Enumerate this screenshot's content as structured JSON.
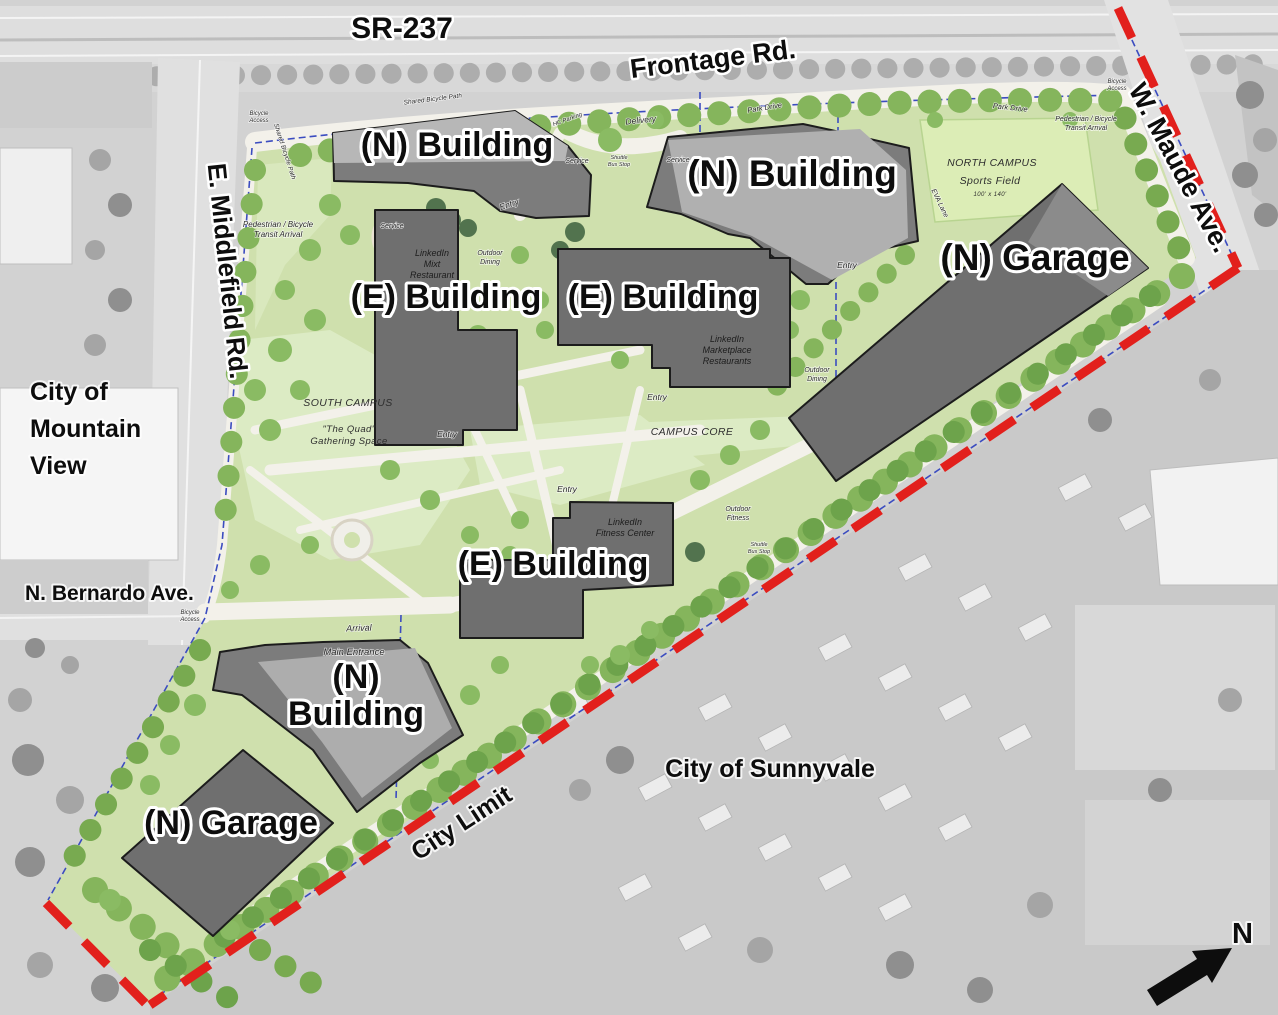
{
  "map_title": "LinkedIn campus site plan",
  "roads": {
    "sr237": "SR-237",
    "frontage": "Frontage Rd.",
    "maude": "W. Maude Ave.",
    "middlefield": "E. Middlefield Rd.",
    "bernardo": "N. Bernardo Ave.",
    "park_drive": "Park Drive",
    "eva_lane": "EVA Lane",
    "shared_path": "Shared Bicycle Path",
    "city_limit": "City Limit"
  },
  "cities": {
    "mountain_view": [
      "City of",
      "Mountain",
      "View"
    ],
    "sunnyvale": "City of Sunnyvale"
  },
  "buildings": {
    "n_building": "(N) Building",
    "e_building": "(E) Building",
    "n_garage": "(N) Garage",
    "n_split": [
      "(N)",
      "Building"
    ]
  },
  "areas": {
    "north_campus": "NORTH CAMPUS",
    "sports_field": "Sports Field",
    "field_dim": "100' x 140'",
    "south_campus": "SOUTH CAMPUS",
    "campus_core": "CAMPUS CORE",
    "quad": [
      "\"The Quad\"",
      "Gathering Space"
    ]
  },
  "facilities": {
    "mixt": [
      "LinkedIn",
      "Mixt",
      "Restaurant"
    ],
    "marketplace": [
      "LinkedIn",
      "Marketplace",
      "Restaurants"
    ],
    "fitness": [
      "LinkedIn",
      "Fitness Center"
    ]
  },
  "notes": {
    "entry": "Entry",
    "service": "Service",
    "delivery": "Delivery",
    "arrival": "Arrival",
    "main_entrance": "Main Entrance",
    "hc_parking": "HC Parking",
    "shuttle": [
      "Shuttle",
      "Bus Stop"
    ],
    "outdoor": "Outdoor",
    "dining": "Dining",
    "fitness_word": "Fitness",
    "ped_transit": [
      "Pedestrian / Bicycle",
      "Transit Arrival"
    ],
    "bicycle_access": [
      "Bicycle",
      "Access"
    ]
  },
  "compass": {
    "north_label": "N"
  },
  "palette": {
    "site_green": "#cfe0ad",
    "lawn_green": "#dcebc4",
    "tree_green": "#85b55c",
    "evergreen": "#52734e",
    "building_gray": "#6f6f6f",
    "boundary_red": "#e2201c",
    "parcel_blue": "#3b4cc0",
    "aerial_gray": "#d2d2d2"
  }
}
